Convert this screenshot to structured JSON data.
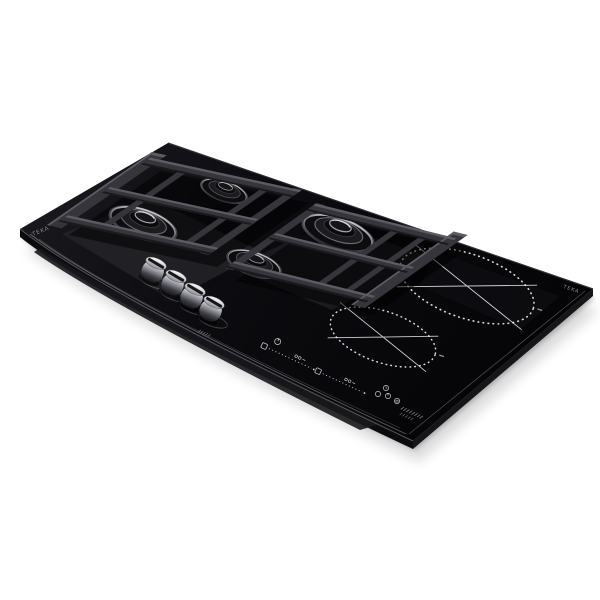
{
  "meta": {
    "description": "Product photo of a black built-in combination cooktop viewed at an angle on a white background: left section is gas-on-glass with four burners, two cast-iron grate modules and four chrome control knobs; right section is a two-zone induction glass with printed zone circles, two touch slider controls and touch buttons.",
    "background_color": "#ffffff"
  },
  "branding": {
    "logo_left": "TEKA",
    "logo_right": "TEKA"
  },
  "cooktop": {
    "type": "gas + induction combination hob",
    "gas_section": {
      "burner_count": 4,
      "knob_count": 4,
      "grate_modules": 2
    },
    "induction_section": {
      "zone_count": 2,
      "slider_count": 2,
      "touch_button_count": 4
    },
    "colors": {
      "glass": "#0a0a0d",
      "glass_sheen": "#232328",
      "grate": "#35353b",
      "grate_highlight": "#5c5c64",
      "knob_chrome": "#c9c9cf",
      "burner_rim": "#9b9ba3",
      "printed_graphics": "#d8d8dd",
      "logo": "#8f8f96",
      "shadow": "rgba(0,0,0,0.16)"
    }
  }
}
